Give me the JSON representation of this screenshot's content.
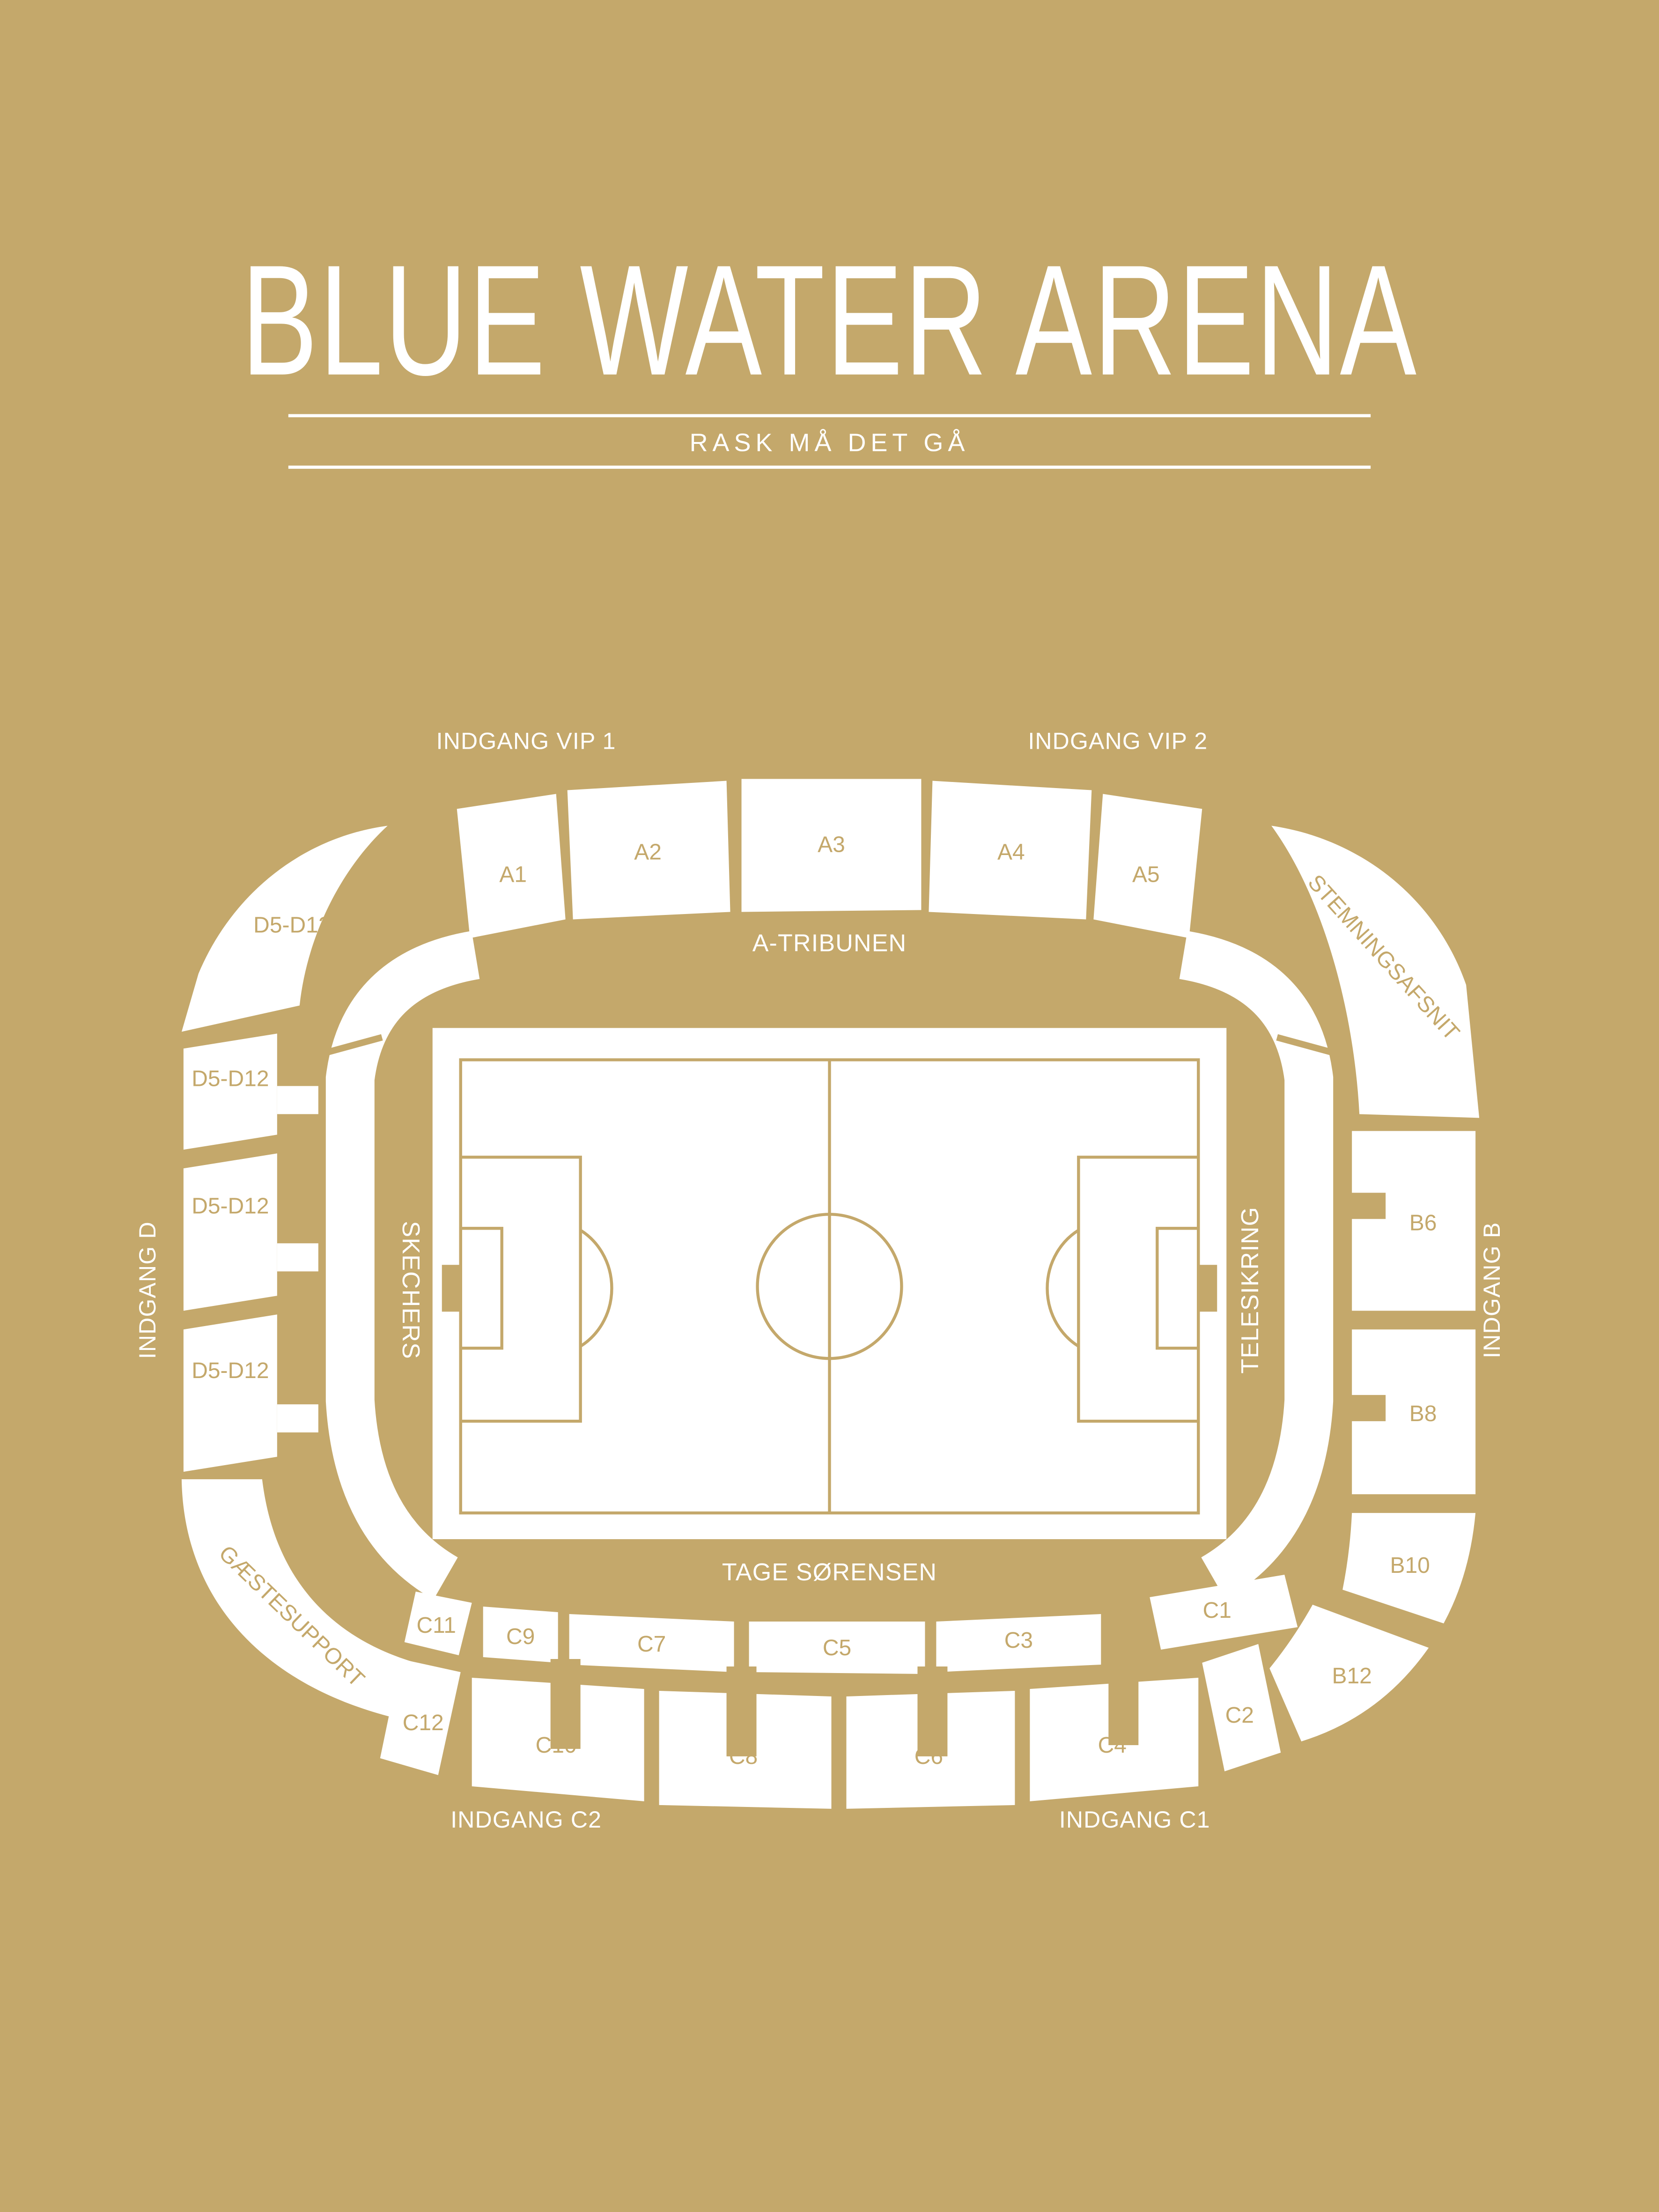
{
  "poster": {
    "title": "BLUE WATER ARENA",
    "subtitle": "RASK MÅ DET GÅ"
  },
  "colors": {
    "background": "#C4A86B",
    "sections": "#FFFFFF",
    "section_label": "#C4A86B"
  },
  "entrances": {
    "vip1": "INDGANG VIP 1",
    "vip2": "INDGANG VIP 2",
    "d": "INDGANG D",
    "b": "INDGANG B",
    "c2": "INDGANG C2",
    "c1": "INDGANG C1"
  },
  "stands": {
    "north": "A-TRIBUNEN",
    "west": "SKECHERS",
    "east": "TELESIKRING",
    "south": "TAGE SØRENSEN",
    "away": "GÆSTESUPPORT",
    "atmosphere": "STEMNINGSAFSNIT"
  },
  "sections": {
    "a": [
      "A1",
      "A2",
      "A3",
      "A4",
      "A5"
    ],
    "d": [
      "D5-D12",
      "D5-D12",
      "D5-D12",
      "D5-D12"
    ],
    "b": [
      "B6",
      "B8",
      "B10",
      "B12"
    ],
    "c_inner": [
      "C11",
      "C9",
      "C7",
      "C5",
      "C3",
      "C1"
    ],
    "c_outer": [
      "C12",
      "C10",
      "C8",
      "C6",
      "C4",
      "C2"
    ]
  }
}
